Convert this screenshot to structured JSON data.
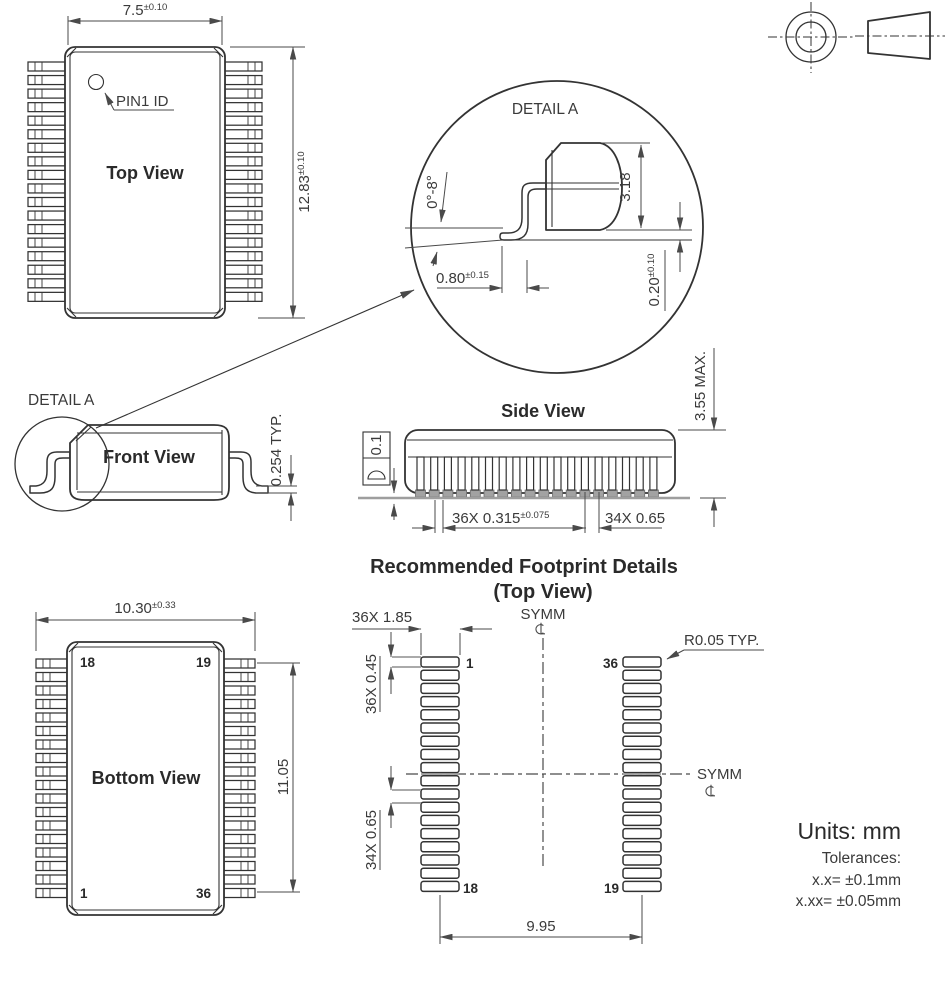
{
  "top_view": {
    "title": "Top View",
    "pin1_label": "PIN1 ID",
    "width_value": "7.5",
    "width_tol": "±0.10",
    "height_value": "12.83",
    "height_tol": "±0.10"
  },
  "detail_a": {
    "label": "DETAIL A",
    "angle": "0°-8°",
    "body_height": "3.18",
    "foot_length": "0.80",
    "foot_length_tol": "±0.15",
    "standoff": "0.20",
    "standoff_tol": "±0.10"
  },
  "front_view": {
    "title": "Front View",
    "detail_label": "DETAIL A",
    "lead_thickness": "0.254 TYP."
  },
  "side_view": {
    "title": "Side View",
    "flatness": "0.1",
    "lead_width": "36X 0.315",
    "lead_width_tol": "±0.075",
    "lead_pitch": "34X 0.65",
    "max_height": "3.55 MAX."
  },
  "bottom_view": {
    "title": "Bottom View",
    "width_value": "10.30",
    "width_tol": "±0.33",
    "pin_span": "11.05",
    "pin_top_left": "18",
    "pin_top_right": "19",
    "pin_bottom_left": "1",
    "pin_bottom_right": "36"
  },
  "footprint": {
    "title": "Recommended Footprint Details",
    "subtitle": "(Top View)",
    "pad_length": "36X 1.85",
    "pad_width": "36X 0.45",
    "pad_pitch": "34X 0.65",
    "span": "9.95",
    "corner_radius": "R0.05 TYP.",
    "symm": "SYMM",
    "pin_left_top": "1",
    "pin_left_bottom": "18",
    "pin_right_top": "36",
    "pin_right_bottom": "19"
  },
  "notes": {
    "units": "Units: mm",
    "tolerances_label": "Tolerances:",
    "tolerance_x": "x.x= ±0.1mm",
    "tolerance_xx": "x.xx= ±0.05mm"
  },
  "icons": {
    "centerline": "℄",
    "projection_circle": "concentric-circles",
    "projection_cone": "truncated-cone"
  }
}
